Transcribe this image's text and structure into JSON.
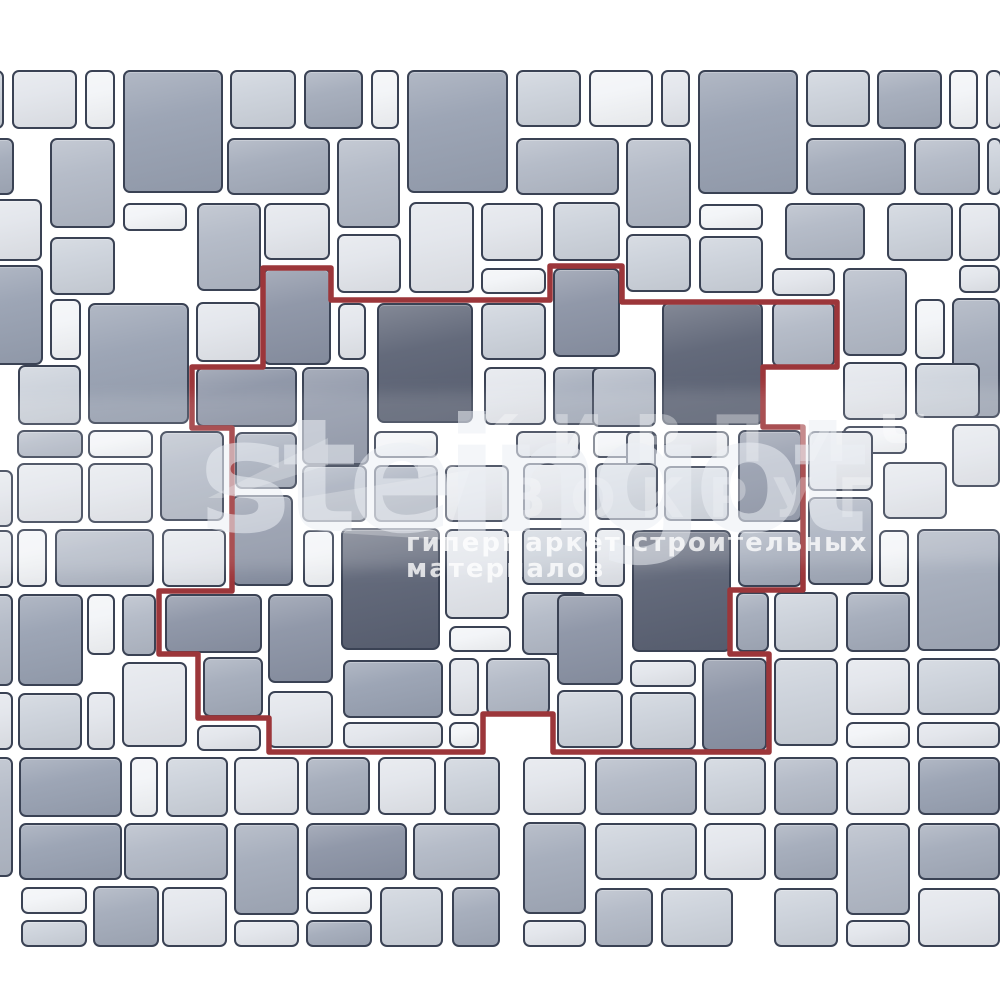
{
  "image_type": "paving layout scheme with highlighted repeating pattern unit",
  "watermark": {
    "brand": "steingot",
    "overlay_word_1": "КИРПИЧ",
    "overlay_word_2": "ВОКРУГ",
    "tagline": "гипермаркет строительных материалов"
  },
  "palette": {
    "canvas": "#ffffff",
    "tile_border": "#3a4254",
    "pattern_outline": "#9c363a",
    "tile_fills": [
      "#f2f4f7",
      "#e2e5eb",
      "#cbd1da",
      "#b1b8c5",
      "#a2aab9",
      "#97a0b1",
      "#8a92a4",
      "#5a6173"
    ]
  },
  "pattern_outline_points": [
    [
      263,
      268
    ],
    [
      331,
      268
    ],
    [
      331,
      300
    ],
    [
      550,
      300
    ],
    [
      550,
      266
    ],
    [
      622,
      266
    ],
    [
      622,
      302
    ],
    [
      837,
      302
    ],
    [
      837,
      367
    ],
    [
      763,
      367
    ],
    [
      763,
      427
    ],
    [
      803,
      427
    ],
    [
      803,
      590
    ],
    [
      730,
      590
    ],
    [
      730,
      654
    ],
    [
      769,
      654
    ],
    [
      769,
      752
    ],
    [
      553,
      752
    ],
    [
      553,
      714
    ],
    [
      483,
      714
    ],
    [
      483,
      752
    ],
    [
      269,
      752
    ],
    [
      269,
      718
    ],
    [
      198,
      718
    ],
    [
      198,
      654
    ],
    [
      159,
      654
    ],
    [
      159,
      591
    ],
    [
      232,
      591
    ],
    [
      232,
      428
    ],
    [
      192,
      428
    ],
    [
      192,
      367
    ],
    [
      263,
      367
    ]
  ],
  "tiles": [
    {
      "x": -22,
      "y": 70,
      "w": 26,
      "h": 59,
      "c": 2
    },
    {
      "x": 12,
      "y": 70,
      "w": 65,
      "h": 59,
      "c": 1
    },
    {
      "x": 85,
      "y": 70,
      "w": 30,
      "h": 59,
      "c": 0
    },
    {
      "x": 123,
      "y": 70,
      "w": 100,
      "h": 123,
      "c": 5
    },
    {
      "x": 230,
      "y": 70,
      "w": 66,
      "h": 59,
      "c": 2
    },
    {
      "x": 304,
      "y": 70,
      "w": 59,
      "h": 59,
      "c": 4
    },
    {
      "x": 371,
      "y": 70,
      "w": 28,
      "h": 59,
      "c": 0
    },
    {
      "x": 407,
      "y": 70,
      "w": 101,
      "h": 123,
      "c": 5
    },
    {
      "x": 516,
      "y": 70,
      "w": 65,
      "h": 57,
      "c": 2
    },
    {
      "x": 589,
      "y": 70,
      "w": 64,
      "h": 57,
      "c": 0
    },
    {
      "x": 661,
      "y": 70,
      "w": 29,
      "h": 57,
      "c": 1
    },
    {
      "x": 698,
      "y": 70,
      "w": 100,
      "h": 124,
      "c": 5
    },
    {
      "x": 806,
      "y": 70,
      "w": 64,
      "h": 57,
      "c": 2
    },
    {
      "x": 877,
      "y": 70,
      "w": 65,
      "h": 59,
      "c": 4
    },
    {
      "x": 949,
      "y": 70,
      "w": 29,
      "h": 59,
      "c": 0
    },
    {
      "x": 986,
      "y": 70,
      "w": 16,
      "h": 59,
      "c": 1
    },
    {
      "x": -18,
      "y": 138,
      "w": 32,
      "h": 57,
      "c": 4
    },
    {
      "x": 50,
      "y": 138,
      "w": 65,
      "h": 90,
      "c": 3
    },
    {
      "x": 227,
      "y": 138,
      "w": 103,
      "h": 57,
      "c": 4
    },
    {
      "x": 337,
      "y": 138,
      "w": 63,
      "h": 90,
      "c": 3
    },
    {
      "x": 516,
      "y": 138,
      "w": 103,
      "h": 57,
      "c": 3
    },
    {
      "x": 626,
      "y": 138,
      "w": 65,
      "h": 90,
      "c": 3
    },
    {
      "x": 806,
      "y": 138,
      "w": 100,
      "h": 57,
      "c": 4
    },
    {
      "x": 914,
      "y": 138,
      "w": 66,
      "h": 57,
      "c": 3
    },
    {
      "x": 987,
      "y": 138,
      "w": 15,
      "h": 57,
      "c": 2
    },
    {
      "x": -24,
      "y": 199,
      "w": 66,
      "h": 62,
      "c": 1
    },
    {
      "x": 123,
      "y": 203,
      "w": 64,
      "h": 28,
      "c": 0
    },
    {
      "x": 197,
      "y": 203,
      "w": 64,
      "h": 88,
      "c": 3
    },
    {
      "x": 264,
      "y": 203,
      "w": 66,
      "h": 57,
      "c": 1
    },
    {
      "x": 409,
      "y": 202,
      "w": 65,
      "h": 91,
      "c": 1
    },
    {
      "x": 481,
      "y": 203,
      "w": 62,
      "h": 58,
      "c": 1
    },
    {
      "x": 553,
      "y": 202,
      "w": 67,
      "h": 59,
      "c": 2
    },
    {
      "x": 699,
      "y": 204,
      "w": 64,
      "h": 26,
      "c": 0
    },
    {
      "x": 785,
      "y": 203,
      "w": 80,
      "h": 57,
      "c": 3
    },
    {
      "x": 887,
      "y": 203,
      "w": 66,
      "h": 58,
      "c": 2
    },
    {
      "x": 959,
      "y": 203,
      "w": 41,
      "h": 58,
      "c": 1
    },
    {
      "x": 50,
      "y": 237,
      "w": 65,
      "h": 58,
      "c": 2
    },
    {
      "x": 337,
      "y": 234,
      "w": 64,
      "h": 59,
      "c": 1
    },
    {
      "x": 626,
      "y": 234,
      "w": 65,
      "h": 58,
      "c": 2
    },
    {
      "x": 699,
      "y": 236,
      "w": 64,
      "h": 57,
      "c": 2
    },
    {
      "x": 959,
      "y": 265,
      "w": 41,
      "h": 28,
      "c": 1
    },
    {
      "x": -23,
      "y": 265,
      "w": 66,
      "h": 100,
      "c": 5
    },
    {
      "x": 50,
      "y": 299,
      "w": 31,
      "h": 61,
      "c": 0
    },
    {
      "x": 88,
      "y": 303,
      "w": 101,
      "h": 121,
      "c": 5
    },
    {
      "x": 196,
      "y": 302,
      "w": 64,
      "h": 60,
      "c": 1
    },
    {
      "x": 263,
      "y": 268,
      "w": 68,
      "h": 97,
      "c": 6
    },
    {
      "x": 338,
      "y": 303,
      "w": 28,
      "h": 57,
      "c": 1
    },
    {
      "x": 377,
      "y": 303,
      "w": 96,
      "h": 120,
      "c": 7
    },
    {
      "x": 481,
      "y": 268,
      "w": 65,
      "h": 26,
      "c": 0
    },
    {
      "x": 481,
      "y": 303,
      "w": 65,
      "h": 57,
      "c": 2
    },
    {
      "x": 553,
      "y": 268,
      "w": 67,
      "h": 89,
      "c": 6
    },
    {
      "x": 662,
      "y": 302,
      "w": 101,
      "h": 123,
      "c": 7
    },
    {
      "x": 772,
      "y": 268,
      "w": 63,
      "h": 28,
      "c": 1
    },
    {
      "x": 772,
      "y": 302,
      "w": 63,
      "h": 65,
      "c": 3
    },
    {
      "x": 843,
      "y": 268,
      "w": 64,
      "h": 88,
      "c": 3
    },
    {
      "x": 915,
      "y": 299,
      "w": 30,
      "h": 60,
      "c": 0
    },
    {
      "x": 952,
      "y": 298,
      "w": 48,
      "h": 120,
      "c": 4
    },
    {
      "x": 18,
      "y": 365,
      "w": 63,
      "h": 60,
      "c": 2
    },
    {
      "x": 17,
      "y": 430,
      "w": 66,
      "h": 28,
      "c": 3
    },
    {
      "x": 88,
      "y": 430,
      "w": 65,
      "h": 28,
      "c": 0
    },
    {
      "x": -15,
      "y": 470,
      "w": 28,
      "h": 57,
      "c": 1
    },
    {
      "x": 17,
      "y": 463,
      "w": 66,
      "h": 60,
      "c": 1
    },
    {
      "x": 88,
      "y": 463,
      "w": 65,
      "h": 60,
      "c": 1
    },
    {
      "x": 160,
      "y": 431,
      "w": 64,
      "h": 90,
      "c": 3
    },
    {
      "x": 196,
      "y": 367,
      "w": 101,
      "h": 60,
      "c": 6
    },
    {
      "x": 302,
      "y": 367,
      "w": 67,
      "h": 98,
      "c": 6
    },
    {
      "x": 484,
      "y": 367,
      "w": 62,
      "h": 58,
      "c": 1
    },
    {
      "x": 553,
      "y": 367,
      "w": 66,
      "h": 58,
      "c": 4
    },
    {
      "x": 592,
      "y": 367,
      "w": 64,
      "h": 60,
      "c": 3
    },
    {
      "x": 843,
      "y": 362,
      "w": 64,
      "h": 58,
      "c": 1
    },
    {
      "x": 915,
      "y": 363,
      "w": 65,
      "h": 55,
      "c": 2
    },
    {
      "x": 843,
      "y": 426,
      "w": 64,
      "h": 28,
      "c": 0
    },
    {
      "x": 952,
      "y": 424,
      "w": 48,
      "h": 63,
      "c": 1
    },
    {
      "x": 235,
      "y": 432,
      "w": 62,
      "h": 57,
      "c": 4
    },
    {
      "x": 374,
      "y": 431,
      "w": 64,
      "h": 27,
      "c": 0
    },
    {
      "x": 516,
      "y": 431,
      "w": 64,
      "h": 27,
      "c": 1
    },
    {
      "x": 593,
      "y": 431,
      "w": 64,
      "h": 27,
      "c": 0
    },
    {
      "x": 626,
      "y": 431,
      "w": 30,
      "h": 89,
      "c": 1
    },
    {
      "x": 664,
      "y": 431,
      "w": 65,
      "h": 27,
      "c": 1
    },
    {
      "x": 664,
      "y": 466,
      "w": 65,
      "h": 55,
      "c": 2
    },
    {
      "x": 738,
      "y": 430,
      "w": 64,
      "h": 92,
      "c": 6
    },
    {
      "x": 302,
      "y": 465,
      "w": 65,
      "h": 57,
      "c": 4
    },
    {
      "x": 374,
      "y": 465,
      "w": 64,
      "h": 57,
      "c": 4
    },
    {
      "x": 445,
      "y": 465,
      "w": 64,
      "h": 57,
      "c": 1
    },
    {
      "x": 523,
      "y": 463,
      "w": 63,
      "h": 57,
      "c": 1
    },
    {
      "x": 595,
      "y": 463,
      "w": 63,
      "h": 57,
      "c": 2
    },
    {
      "x": 808,
      "y": 431,
      "w": 65,
      "h": 60,
      "c": 1
    },
    {
      "x": 883,
      "y": 462,
      "w": 64,
      "h": 57,
      "c": 1
    },
    {
      "x": 808,
      "y": 497,
      "w": 65,
      "h": 88,
      "c": 4
    },
    {
      "x": -15,
      "y": 530,
      "w": 28,
      "h": 58,
      "c": 1
    },
    {
      "x": 17,
      "y": 529,
      "w": 30,
      "h": 58,
      "c": 0
    },
    {
      "x": 55,
      "y": 529,
      "w": 99,
      "h": 58,
      "c": 3
    },
    {
      "x": 162,
      "y": 529,
      "w": 64,
      "h": 58,
      "c": 1
    },
    {
      "x": 232,
      "y": 495,
      "w": 61,
      "h": 91,
      "c": 6
    },
    {
      "x": 303,
      "y": 530,
      "w": 31,
      "h": 57,
      "c": 0
    },
    {
      "x": 341,
      "y": 528,
      "w": 99,
      "h": 122,
      "c": 7
    },
    {
      "x": 445,
      "y": 529,
      "w": 64,
      "h": 90,
      "c": 1
    },
    {
      "x": 522,
      "y": 528,
      "w": 65,
      "h": 57,
      "c": 2
    },
    {
      "x": 595,
      "y": 528,
      "w": 30,
      "h": 59,
      "c": 1
    },
    {
      "x": 632,
      "y": 530,
      "w": 99,
      "h": 122,
      "c": 7
    },
    {
      "x": 738,
      "y": 530,
      "w": 64,
      "h": 57,
      "c": 4
    },
    {
      "x": 879,
      "y": 530,
      "w": 30,
      "h": 57,
      "c": 0
    },
    {
      "x": 917,
      "y": 529,
      "w": 83,
      "h": 122,
      "c": 4
    },
    {
      "x": -20,
      "y": 594,
      "w": 33,
      "h": 92,
      "c": 3
    },
    {
      "x": 18,
      "y": 594,
      "w": 65,
      "h": 92,
      "c": 5
    },
    {
      "x": 87,
      "y": 594,
      "w": 28,
      "h": 61,
      "c": 0
    },
    {
      "x": 122,
      "y": 594,
      "w": 34,
      "h": 62,
      "c": 3
    },
    {
      "x": 165,
      "y": 594,
      "w": 97,
      "h": 59,
      "c": 6
    },
    {
      "x": 268,
      "y": 594,
      "w": 65,
      "h": 89,
      "c": 6
    },
    {
      "x": 449,
      "y": 626,
      "w": 62,
      "h": 26,
      "c": 0
    },
    {
      "x": 522,
      "y": 592,
      "w": 65,
      "h": 63,
      "c": 3
    },
    {
      "x": 557,
      "y": 594,
      "w": 66,
      "h": 91,
      "c": 6
    },
    {
      "x": 736,
      "y": 592,
      "w": 33,
      "h": 60,
      "c": 4
    },
    {
      "x": 774,
      "y": 592,
      "w": 64,
      "h": 60,
      "c": 2
    },
    {
      "x": 846,
      "y": 592,
      "w": 64,
      "h": 60,
      "c": 4
    },
    {
      "x": 203,
      "y": 657,
      "w": 60,
      "h": 60,
      "c": 4
    },
    {
      "x": 268,
      "y": 691,
      "w": 65,
      "h": 57,
      "c": 1
    },
    {
      "x": 343,
      "y": 660,
      "w": 100,
      "h": 58,
      "c": 5
    },
    {
      "x": 449,
      "y": 658,
      "w": 30,
      "h": 58,
      "c": 1
    },
    {
      "x": 486,
      "y": 658,
      "w": 64,
      "h": 57,
      "c": 3
    },
    {
      "x": 557,
      "y": 690,
      "w": 66,
      "h": 58,
      "c": 2
    },
    {
      "x": 630,
      "y": 660,
      "w": 66,
      "h": 27,
      "c": 1
    },
    {
      "x": 630,
      "y": 692,
      "w": 66,
      "h": 58,
      "c": 2
    },
    {
      "x": 702,
      "y": 658,
      "w": 65,
      "h": 93,
      "c": 6
    },
    {
      "x": 774,
      "y": 658,
      "w": 64,
      "h": 88,
      "c": 2
    },
    {
      "x": 846,
      "y": 658,
      "w": 64,
      "h": 57,
      "c": 1
    },
    {
      "x": 917,
      "y": 658,
      "w": 83,
      "h": 57,
      "c": 2
    },
    {
      "x": -15,
      "y": 692,
      "w": 28,
      "h": 58,
      "c": 1
    },
    {
      "x": 18,
      "y": 693,
      "w": 64,
      "h": 57,
      "c": 2
    },
    {
      "x": 87,
      "y": 692,
      "w": 28,
      "h": 58,
      "c": 1
    },
    {
      "x": 122,
      "y": 662,
      "w": 65,
      "h": 85,
      "c": 1
    },
    {
      "x": 197,
      "y": 725,
      "w": 64,
      "h": 26,
      "c": 1
    },
    {
      "x": 343,
      "y": 722,
      "w": 100,
      "h": 26,
      "c": 1
    },
    {
      "x": 449,
      "y": 722,
      "w": 30,
      "h": 26,
      "c": 0
    },
    {
      "x": 846,
      "y": 722,
      "w": 64,
      "h": 26,
      "c": 0
    },
    {
      "x": 917,
      "y": 722,
      "w": 83,
      "h": 26,
      "c": 1
    },
    {
      "x": -15,
      "y": 757,
      "w": 28,
      "h": 120,
      "c": 3
    },
    {
      "x": 19,
      "y": 757,
      "w": 103,
      "h": 60,
      "c": 5
    },
    {
      "x": 130,
      "y": 757,
      "w": 28,
      "h": 60,
      "c": 0
    },
    {
      "x": 166,
      "y": 757,
      "w": 62,
      "h": 60,
      "c": 2
    },
    {
      "x": 234,
      "y": 757,
      "w": 65,
      "h": 58,
      "c": 1
    },
    {
      "x": 306,
      "y": 757,
      "w": 64,
      "h": 58,
      "c": 4
    },
    {
      "x": 378,
      "y": 757,
      "w": 58,
      "h": 58,
      "c": 1
    },
    {
      "x": 444,
      "y": 757,
      "w": 56,
      "h": 58,
      "c": 2
    },
    {
      "x": 523,
      "y": 757,
      "w": 63,
      "h": 58,
      "c": 1
    },
    {
      "x": 595,
      "y": 757,
      "w": 102,
      "h": 58,
      "c": 3
    },
    {
      "x": 704,
      "y": 757,
      "w": 62,
      "h": 58,
      "c": 2
    },
    {
      "x": 774,
      "y": 757,
      "w": 64,
      "h": 58,
      "c": 3
    },
    {
      "x": 846,
      "y": 757,
      "w": 64,
      "h": 58,
      "c": 1
    },
    {
      "x": 918,
      "y": 757,
      "w": 82,
      "h": 58,
      "c": 5
    },
    {
      "x": 19,
      "y": 823,
      "w": 103,
      "h": 57,
      "c": 5
    },
    {
      "x": 124,
      "y": 823,
      "w": 104,
      "h": 57,
      "c": 3
    },
    {
      "x": 234,
      "y": 823,
      "w": 65,
      "h": 92,
      "c": 4
    },
    {
      "x": 306,
      "y": 823,
      "w": 101,
      "h": 57,
      "c": 6
    },
    {
      "x": 413,
      "y": 823,
      "w": 87,
      "h": 57,
      "c": 3
    },
    {
      "x": 523,
      "y": 822,
      "w": 63,
      "h": 92,
      "c": 4
    },
    {
      "x": 595,
      "y": 823,
      "w": 102,
      "h": 57,
      "c": 2
    },
    {
      "x": 704,
      "y": 823,
      "w": 62,
      "h": 57,
      "c": 1
    },
    {
      "x": 774,
      "y": 823,
      "w": 64,
      "h": 57,
      "c": 4
    },
    {
      "x": 846,
      "y": 823,
      "w": 64,
      "h": 92,
      "c": 3
    },
    {
      "x": 918,
      "y": 823,
      "w": 82,
      "h": 57,
      "c": 4
    },
    {
      "x": 21,
      "y": 887,
      "w": 66,
      "h": 27,
      "c": 0
    },
    {
      "x": 21,
      "y": 920,
      "w": 66,
      "h": 27,
      "c": 2
    },
    {
      "x": 93,
      "y": 886,
      "w": 66,
      "h": 61,
      "c": 4
    },
    {
      "x": 162,
      "y": 887,
      "w": 65,
      "h": 60,
      "c": 1
    },
    {
      "x": 234,
      "y": 920,
      "w": 65,
      "h": 27,
      "c": 1
    },
    {
      "x": 306,
      "y": 887,
      "w": 66,
      "h": 27,
      "c": 0
    },
    {
      "x": 306,
      "y": 920,
      "w": 66,
      "h": 27,
      "c": 4
    },
    {
      "x": 380,
      "y": 887,
      "w": 63,
      "h": 60,
      "c": 2
    },
    {
      "x": 452,
      "y": 887,
      "w": 48,
      "h": 60,
      "c": 4
    },
    {
      "x": 523,
      "y": 920,
      "w": 63,
      "h": 27,
      "c": 1
    },
    {
      "x": 595,
      "y": 888,
      "w": 58,
      "h": 59,
      "c": 3
    },
    {
      "x": 661,
      "y": 888,
      "w": 72,
      "h": 59,
      "c": 2
    },
    {
      "x": 774,
      "y": 888,
      "w": 64,
      "h": 59,
      "c": 2
    },
    {
      "x": 846,
      "y": 920,
      "w": 64,
      "h": 27,
      "c": 1
    },
    {
      "x": 918,
      "y": 888,
      "w": 82,
      "h": 59,
      "c": 1
    }
  ]
}
